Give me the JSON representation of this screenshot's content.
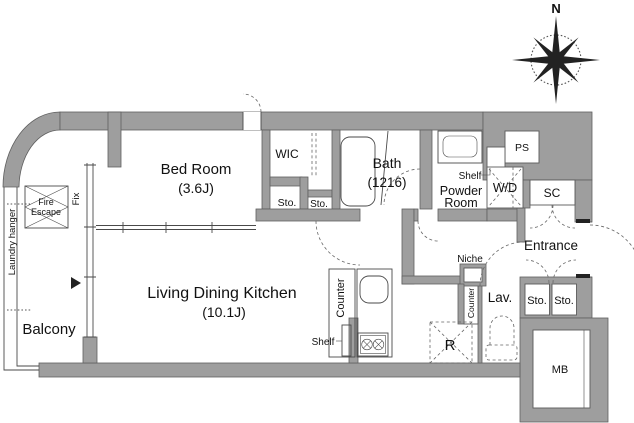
{
  "meta": {
    "type": "apartment-floor-plan"
  },
  "compass": {
    "north": "N"
  },
  "rooms": {
    "bedroom": {
      "name": "Bed Room",
      "size": "(3.6J)"
    },
    "ldk": {
      "name": "Living Dining Kitchen",
      "size": "(10.1J)"
    },
    "bath": {
      "name": "Bath",
      "size": "(1216)"
    },
    "wic": {
      "label": "WIC"
    },
    "powder": {
      "line1": "Powder",
      "line2": "Room"
    },
    "entrance": {
      "label": "Entrance"
    },
    "lav": {
      "label": "Lav."
    },
    "balcony": {
      "label": "Balcony"
    }
  },
  "fixtures": {
    "sto": "Sto.",
    "shelf": "Shelf",
    "wd": "W/D",
    "ps": "PS",
    "sc": "SC",
    "mb": "MB",
    "niche": "Niche",
    "counter": "Counter",
    "fridge": "R",
    "fix": "Fix",
    "fire1": "Fire",
    "fire2": "Escape",
    "laundry": "Laundry hanger"
  },
  "colors": {
    "wall": "#9e9e9e",
    "line": "#4a4a4a",
    "text": "#111111",
    "bg": "#ffffff"
  }
}
